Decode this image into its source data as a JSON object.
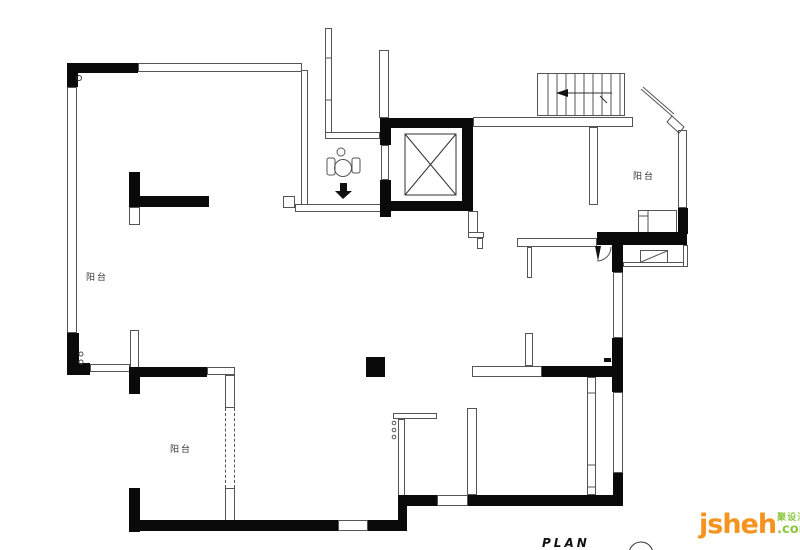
{
  "labels": {
    "balcony_left": "阳台",
    "balcony_bottom": "阳台",
    "balcony_right": "阳台"
  },
  "footer": {
    "plan_title": "PLAN"
  },
  "branding": {
    "name": "jsheh",
    "suffix": ".com",
    "chinese": "聚设汇"
  },
  "colors": {
    "wall": "#0a0a0a",
    "line": "#555555",
    "background": "#ffffff",
    "logo_orange": "#F6921E",
    "logo_green": "#8CC63E"
  }
}
